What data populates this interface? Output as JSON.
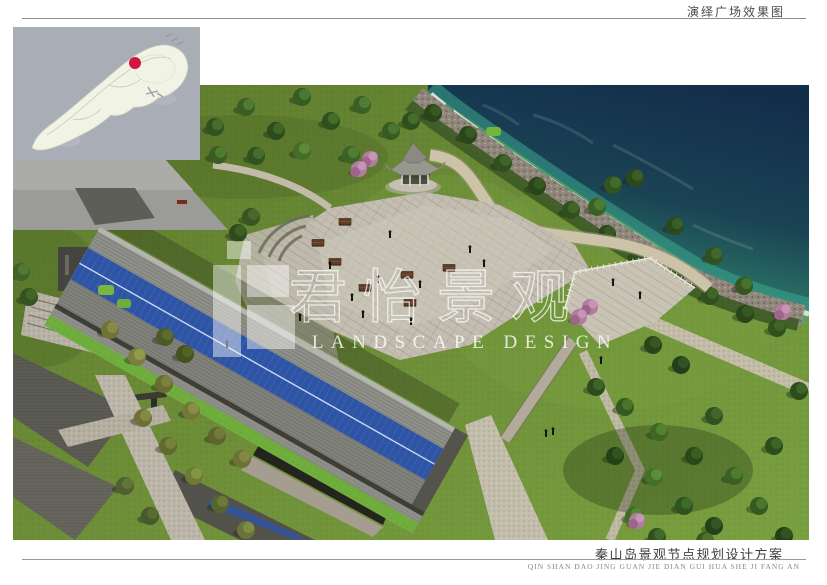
{
  "header": {
    "title": "演绎广场效果图"
  },
  "footer": {
    "title": "秦山岛景观节点规划设计方案",
    "pinyin": "QIN SHAN DAO JING GUAN JIE DIAN GUI HUA SHE JI FANG AN"
  },
  "watermark": {
    "cn": "君怡景观",
    "en": "LANDSCAPE DESIGN"
  },
  "inset_map": {
    "marker_color": "#d31540",
    "island_color": "#f1f3e4",
    "water_color": "#a9aeb6"
  },
  "scene": {
    "sea_deep_color": "#132e4b",
    "sea_shallow_color": "#3da184",
    "lawn_color": "#668232",
    "plaza_color": "#c3beb1",
    "solar_panel_color": "#2e55a5",
    "roof_color": "#84847f",
    "path_color": "#cdc3a8",
    "blossom_color": "#b37ba2"
  }
}
